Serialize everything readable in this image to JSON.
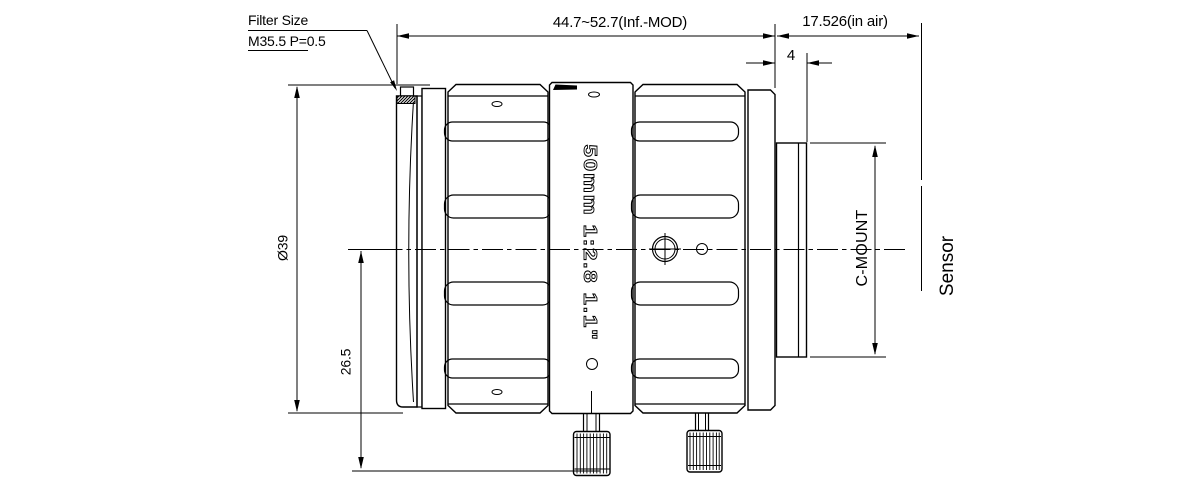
{
  "colors": {
    "ink": "#000000",
    "paper": "#ffffff"
  },
  "note_filter": {
    "title": "Filter Size",
    "spec": "M35.5 P=0.5"
  },
  "dimensions": {
    "overall_length": "44.7~52.7(Inf.-MOD)",
    "flange_to_sensor": "17.526(in air)",
    "thread_length": "4",
    "front_diameter": "Ø39",
    "axis_to_base": "26.5"
  },
  "labels": {
    "mount": "C-MOUNT",
    "sensor": "Sensor",
    "engraving": "50mm  1:2.8  1.1\""
  }
}
